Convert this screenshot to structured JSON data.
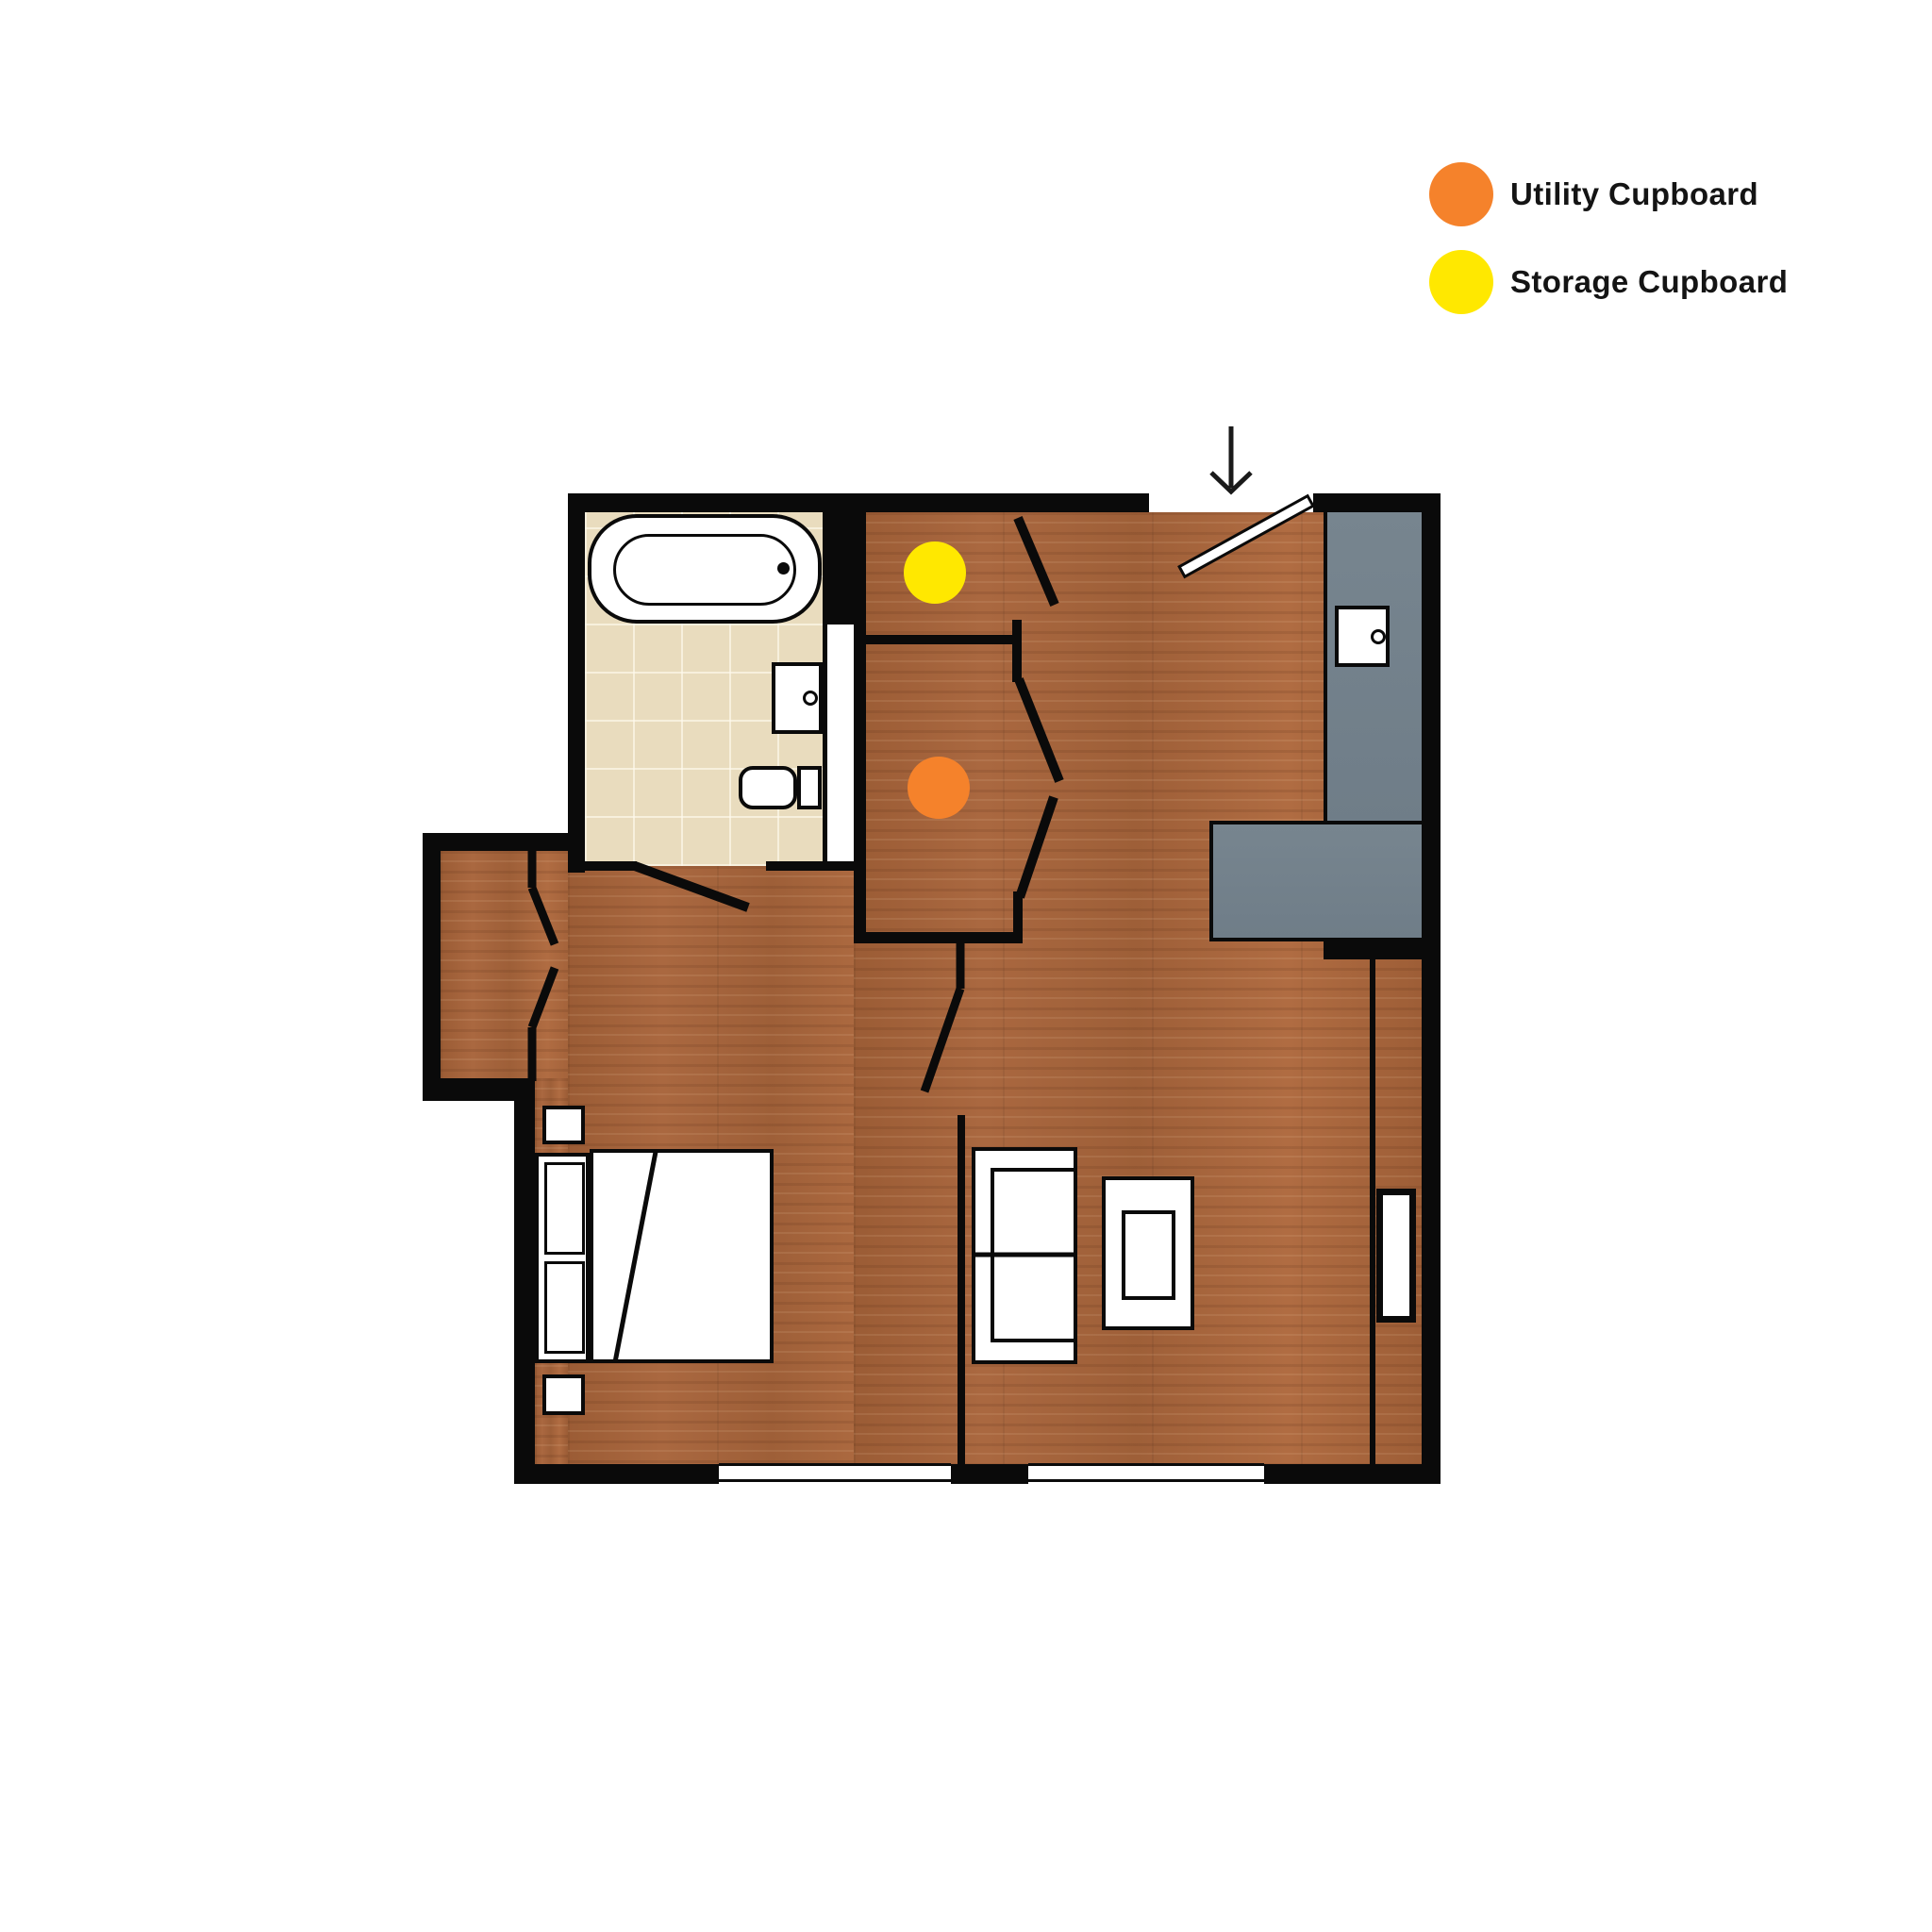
{
  "legend": {
    "items": [
      {
        "id": "utility-cupboard",
        "label": "Utility Cupboard",
        "color": "#F5822B"
      },
      {
        "id": "storage-cupboard",
        "label": "Storage Cupboard",
        "color": "#FFE800"
      }
    ]
  },
  "markers": [
    {
      "name": "storage-cupboard-marker",
      "color": "#FFE800"
    },
    {
      "name": "utility-cupboard-marker",
      "color": "#F5822B"
    }
  ],
  "palette": {
    "wall": "#0A0A0A",
    "wood_floor": "#A2613A",
    "bathroom_tile": "#E9DCBE",
    "kitchen_counter": "#73818C",
    "background": "#FFFFFF"
  },
  "icons": [
    "entry-arrow-icon",
    "entry-door-leaf-icon",
    "bathtub-icon",
    "sink-icon",
    "toilet-icon",
    "double-bed-icon",
    "nightstand-icon",
    "sofa-icon",
    "coffee-table-icon",
    "kitchen-counter-icon",
    "kitchen-sink-unit-icon",
    "radiator-icon",
    "door-swing-icon",
    "window-icon"
  ]
}
